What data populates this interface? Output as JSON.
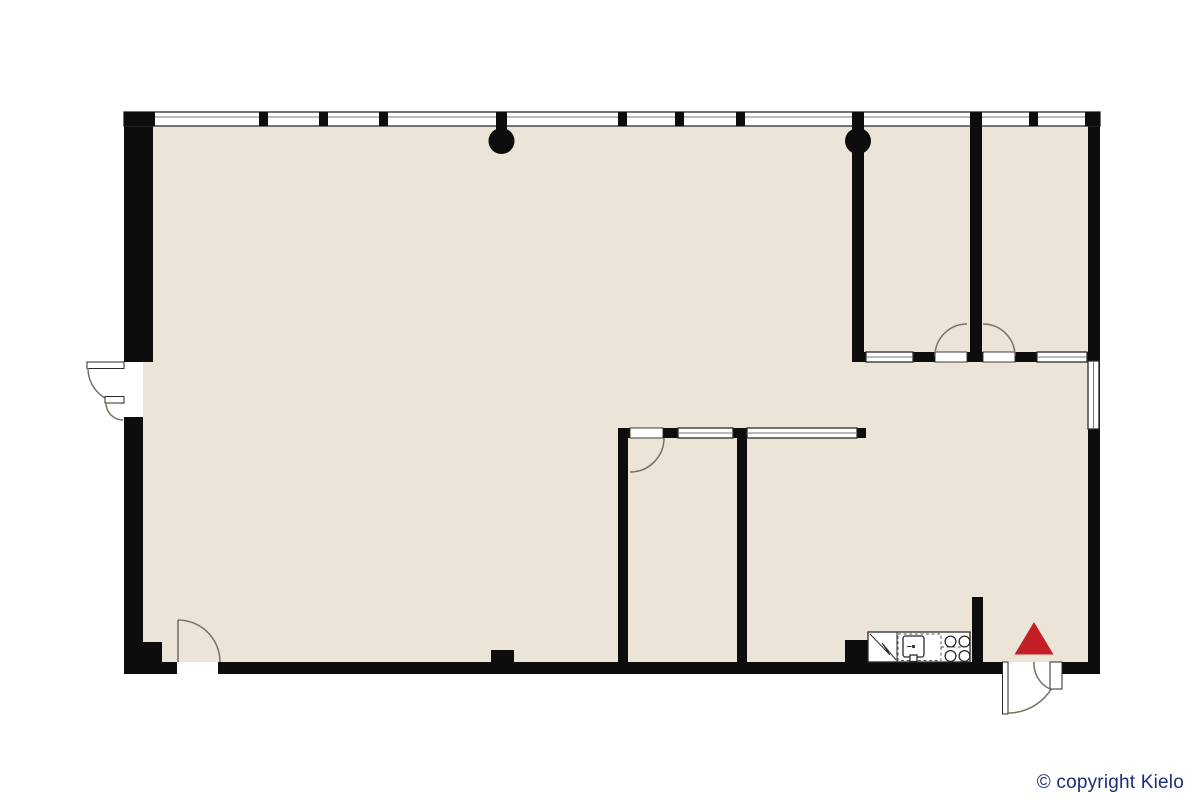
{
  "canvas": {
    "width": 1200,
    "height": 800,
    "background": "#ffffff"
  },
  "colors": {
    "floor": "#ece4d6",
    "wall": "#0d0d0d",
    "window_frame": "#2b2b2b",
    "window_mid": "#777777",
    "door_arc": "#7a7065",
    "dashed_appliance": "#555555",
    "accent_red": "#c41f25",
    "copyright_blue": "#1d2d7c"
  },
  "footer": {
    "copyright": "© copyright Kielo"
  },
  "floorplan": {
    "type": "floor-plan",
    "structural_columns": 2,
    "top_wall_window_segments": 11,
    "interior_glazed_panels": 4,
    "right_wall_windows": 1,
    "doors": [
      "left-exterior-double-door",
      "bottom-left-interior-door",
      "room-a-door",
      "room-b-door",
      "room-c-door",
      "bottom-right-exterior-double-door"
    ],
    "kitchen_appliances": [
      "refrigerator",
      "dishwasher",
      "sink",
      "stove"
    ],
    "markers": [
      {
        "name": "entrance-marker",
        "shape": "triangle",
        "color": "#c41f25"
      }
    ]
  }
}
